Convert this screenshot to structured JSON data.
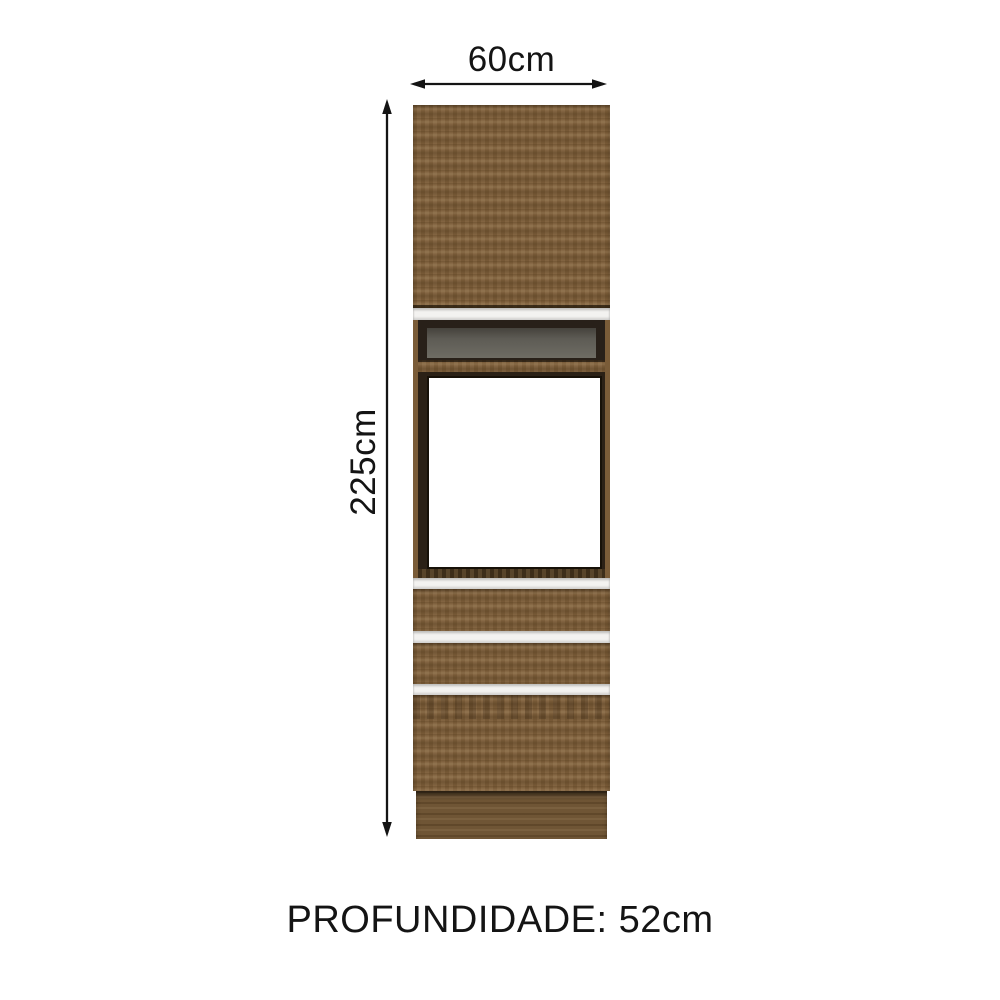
{
  "dimensions": {
    "width_label": "60cm",
    "height_label": "225cm",
    "depth_label": "PROFUNDIDADE: 52cm"
  },
  "icons": {
    "width_arrow": "horizontal-double-arrow",
    "height_arrow": "vertical-double-arrow"
  },
  "colors": {
    "background": "#ffffff",
    "annotation_text": "#141414",
    "wood": "#7e5f3a",
    "wood_plinth": "#6f5535",
    "divider_white": "#f3f2f0",
    "frame_dark": "#2b2116",
    "niche_back_gray": "#6e6c64",
    "oven_cavity_white": "#ffffff"
  }
}
